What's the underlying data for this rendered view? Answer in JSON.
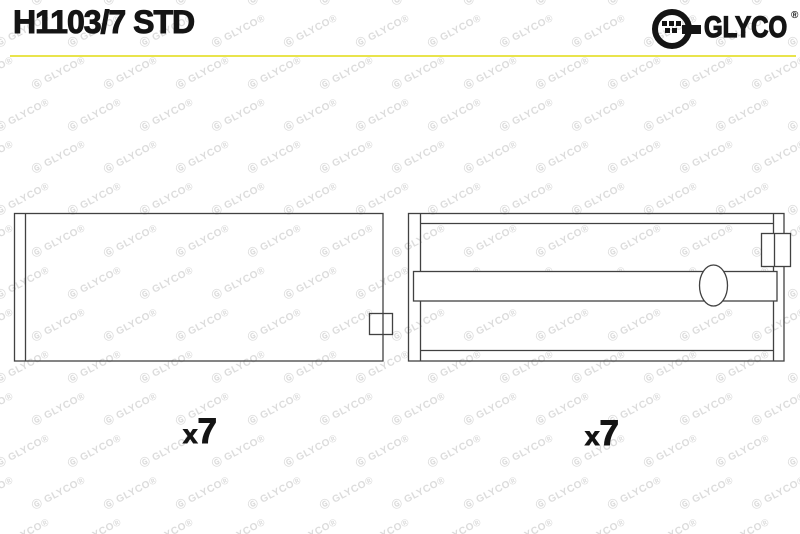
{
  "header": {
    "part_number": "H1103/7 STD"
  },
  "logo": {
    "brand": "GLYCO",
    "registered_mark": "®"
  },
  "watermark": {
    "icon": "Ⓖ",
    "text": "GLYCO",
    "registered": "®"
  },
  "drawings": {
    "left": {
      "quantity_label": "x7"
    },
    "right": {
      "quantity_label": "x7"
    }
  },
  "colors": {
    "accent": "#e9e44c",
    "line": "#414141",
    "ink": "#141414",
    "watermark": "#dcdcdc"
  }
}
